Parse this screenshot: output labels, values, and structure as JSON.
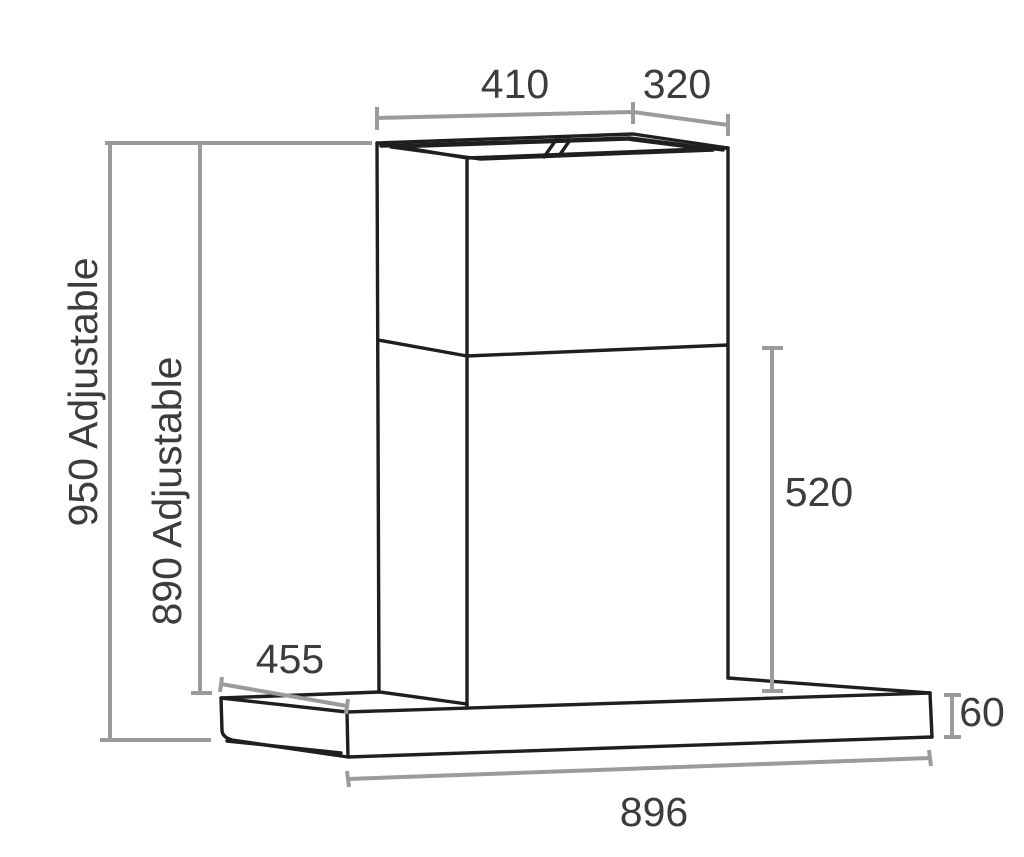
{
  "diagram": {
    "labels": {
      "top_width": "410",
      "top_depth": "320",
      "overall_height": "950 Adjustable",
      "reduced_height": "890 Adjustable",
      "lower_chimney_height": "520",
      "canopy_side_depth": "455",
      "canopy_thickness": "60",
      "canopy_width": "896"
    },
    "colors": {
      "background": "#ffffff",
      "line_black": "#1f1f1f",
      "dimension_gray": "#9b9b9b",
      "text_gray": "#3c3c3c"
    }
  }
}
